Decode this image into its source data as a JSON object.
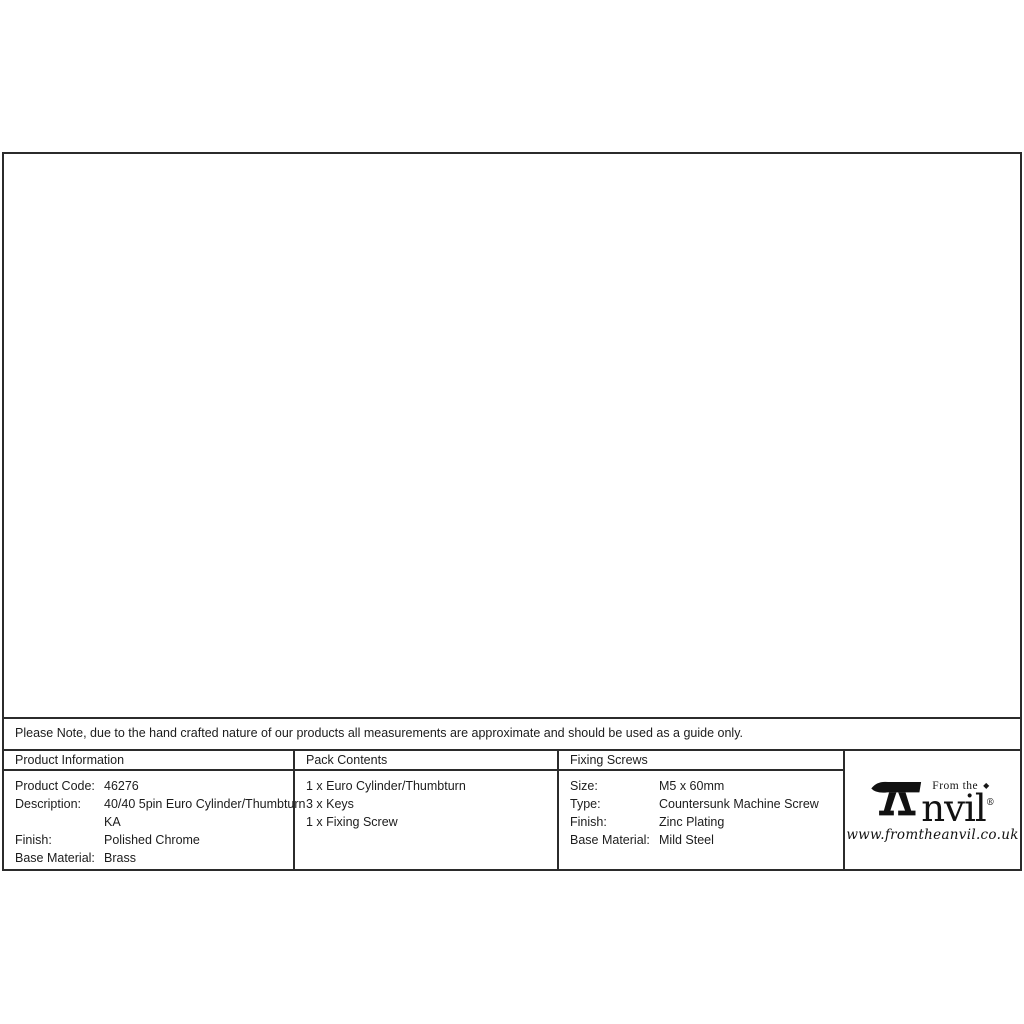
{
  "note": {
    "text": "Please Note, due to the hand crafted nature of our products all measurements are approximate and should be used as a guide only."
  },
  "drawing": {
    "dimensions": {
      "front_height": "32.5",
      "body_length": "80",
      "turn_depth": "20",
      "rear_width": "20",
      "rear_height": "29"
    }
  },
  "table": {
    "product_information": {
      "header": "Product Information",
      "rows": [
        {
          "label": "Product Code:",
          "value": "46276"
        },
        {
          "label": "Description:",
          "value": "40/40 5pin Euro Cylinder/Thumbturn"
        },
        {
          "label": "",
          "value": "KA"
        },
        {
          "label": "Finish:",
          "value": "Polished Chrome"
        },
        {
          "label": "Base Material:",
          "value": "Brass"
        }
      ]
    },
    "pack_contents": {
      "header": "Pack Contents",
      "items": [
        "1 x Euro Cylinder/Thumbturn",
        "3 x Keys",
        "1 x Fixing Screw"
      ]
    },
    "fixing_screws": {
      "header": "Fixing Screws",
      "rows": [
        {
          "label": "Size:",
          "value": "M5 x 60mm"
        },
        {
          "label": "Type:",
          "value": "Countersunk Machine Screw"
        },
        {
          "label": "Finish:",
          "value": "Zinc Plating"
        },
        {
          "label": "Base Material:",
          "value": "Mild Steel"
        }
      ]
    }
  },
  "logo": {
    "tagline": "From the",
    "diamond": "◆",
    "name": "nvil",
    "registered": "®",
    "website": "www.fromtheanvil.co.uk"
  }
}
